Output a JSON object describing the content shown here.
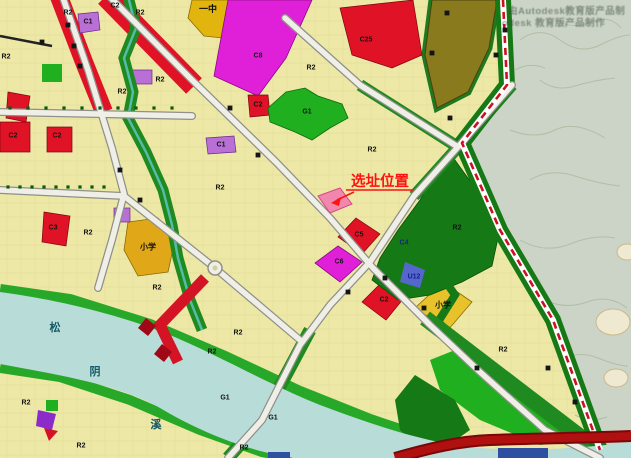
{
  "map": {
    "type": "urban-planning-zoning-map",
    "callout": {
      "text": "选址位置"
    },
    "watermark": {
      "line1": "由Autodesk教育版产品制",
      "line2": "odesk 教育版产品制作"
    },
    "palette": {
      "residential_yellow": "#EDE8A6",
      "school_gold": "#E2B40E",
      "commercial_red": "#E01225",
      "magenta": "#E020D8",
      "purple": "#B86FD6",
      "park_green": "#1FAF1F",
      "dark_green": "#157A15",
      "olive": "#8A7A1E",
      "river_cyan": "#B8DCD8",
      "topo_gray": "#CBD4C6",
      "road_fill": "#EFEFE8",
      "rail_red": "#CC1122",
      "highway_red": "#B01010",
      "site_pink": "#F287AE",
      "callout_red": "#FF1212",
      "utility_blue": "#5566CC"
    },
    "place_labels": [
      {
        "text": "一中",
        "x": 208,
        "y": 9,
        "size": 9,
        "color": "#101010"
      },
      {
        "text": "小学",
        "x": 148,
        "y": 247,
        "size": 8,
        "color": "#101010"
      },
      {
        "text": "小学",
        "x": 443,
        "y": 305,
        "size": 8,
        "color": "#101010"
      },
      {
        "text": "松",
        "x": 55,
        "y": 328,
        "size": 11,
        "color": "#155A66"
      },
      {
        "text": "阴",
        "x": 95,
        "y": 372,
        "size": 11,
        "color": "#155A66"
      },
      {
        "text": "溪",
        "x": 156,
        "y": 425,
        "size": 11,
        "color": "#155A66"
      }
    ],
    "zone_labels": [
      {
        "text": "R2",
        "x": 6,
        "y": 57
      },
      {
        "text": "R2",
        "x": 68,
        "y": 13
      },
      {
        "text": "R2",
        "x": 140,
        "y": 13
      },
      {
        "text": "R2",
        "x": 122,
        "y": 92
      },
      {
        "text": "R2",
        "x": 160,
        "y": 80
      },
      {
        "text": "R2",
        "x": 220,
        "y": 188
      },
      {
        "text": "R2",
        "x": 311,
        "y": 68
      },
      {
        "text": "R2",
        "x": 372,
        "y": 150
      },
      {
        "text": "R2",
        "x": 88,
        "y": 233
      },
      {
        "text": "R2",
        "x": 157,
        "y": 288
      },
      {
        "text": "R2",
        "x": 238,
        "y": 333
      },
      {
        "text": "R2",
        "x": 212,
        "y": 352
      },
      {
        "text": "R2",
        "x": 26,
        "y": 403
      },
      {
        "text": "R2",
        "x": 81,
        "y": 446
      },
      {
        "text": "R2",
        "x": 244,
        "y": 448
      },
      {
        "text": "R2",
        "x": 457,
        "y": 228
      },
      {
        "text": "R2",
        "x": 503,
        "y": 350
      },
      {
        "text": "C2",
        "x": 115,
        "y": 6
      },
      {
        "text": "C2",
        "x": 13,
        "y": 136
      },
      {
        "text": "C2",
        "x": 57,
        "y": 136
      },
      {
        "text": "C2",
        "x": 258,
        "y": 105
      },
      {
        "text": "C2",
        "x": 384,
        "y": 300
      },
      {
        "text": "C1",
        "x": 88,
        "y": 22
      },
      {
        "text": "C1",
        "x": 221,
        "y": 145
      },
      {
        "text": "C25",
        "x": 366,
        "y": 40
      },
      {
        "text": "C3",
        "x": 53,
        "y": 228
      },
      {
        "text": "C5",
        "x": 359,
        "y": 235
      },
      {
        "text": "C6",
        "x": 339,
        "y": 262
      },
      {
        "text": "C8",
        "x": 258,
        "y": 56
      },
      {
        "text": "G1",
        "x": 307,
        "y": 112
      },
      {
        "text": "G1",
        "x": 225,
        "y": 398
      },
      {
        "text": "G1",
        "x": 273,
        "y": 418
      },
      {
        "text": "C4",
        "x": 404,
        "y": 243,
        "color": "#16228E"
      },
      {
        "text": "U12",
        "x": 414,
        "y": 277,
        "color": "#16228E"
      }
    ],
    "road_name_marks": [
      [
        68,
        25
      ],
      [
        74,
        46
      ],
      [
        80,
        66
      ],
      [
        42,
        42
      ],
      [
        120,
        170
      ],
      [
        140,
        200
      ],
      [
        230,
        108
      ],
      [
        258,
        155
      ],
      [
        348,
        292
      ],
      [
        385,
        278
      ],
      [
        424,
        308
      ],
      [
        477,
        368
      ],
      [
        432,
        53
      ],
      [
        450,
        118
      ],
      [
        496,
        55
      ],
      [
        505,
        30
      ],
      [
        548,
        368
      ],
      [
        575,
        402
      ],
      [
        447,
        13
      ]
    ],
    "street_trees": [
      [
        10,
        108
      ],
      [
        28,
        108
      ],
      [
        46,
        108
      ],
      [
        64,
        108
      ],
      [
        82,
        108
      ],
      [
        100,
        108
      ],
      [
        118,
        108
      ],
      [
        136,
        108
      ],
      [
        154,
        108
      ],
      [
        172,
        108
      ],
      [
        8,
        187
      ],
      [
        20,
        187
      ],
      [
        32,
        187
      ],
      [
        44,
        187
      ],
      [
        56,
        187
      ],
      [
        68,
        187
      ],
      [
        80,
        187
      ],
      [
        92,
        187
      ],
      [
        104,
        187
      ]
    ]
  }
}
